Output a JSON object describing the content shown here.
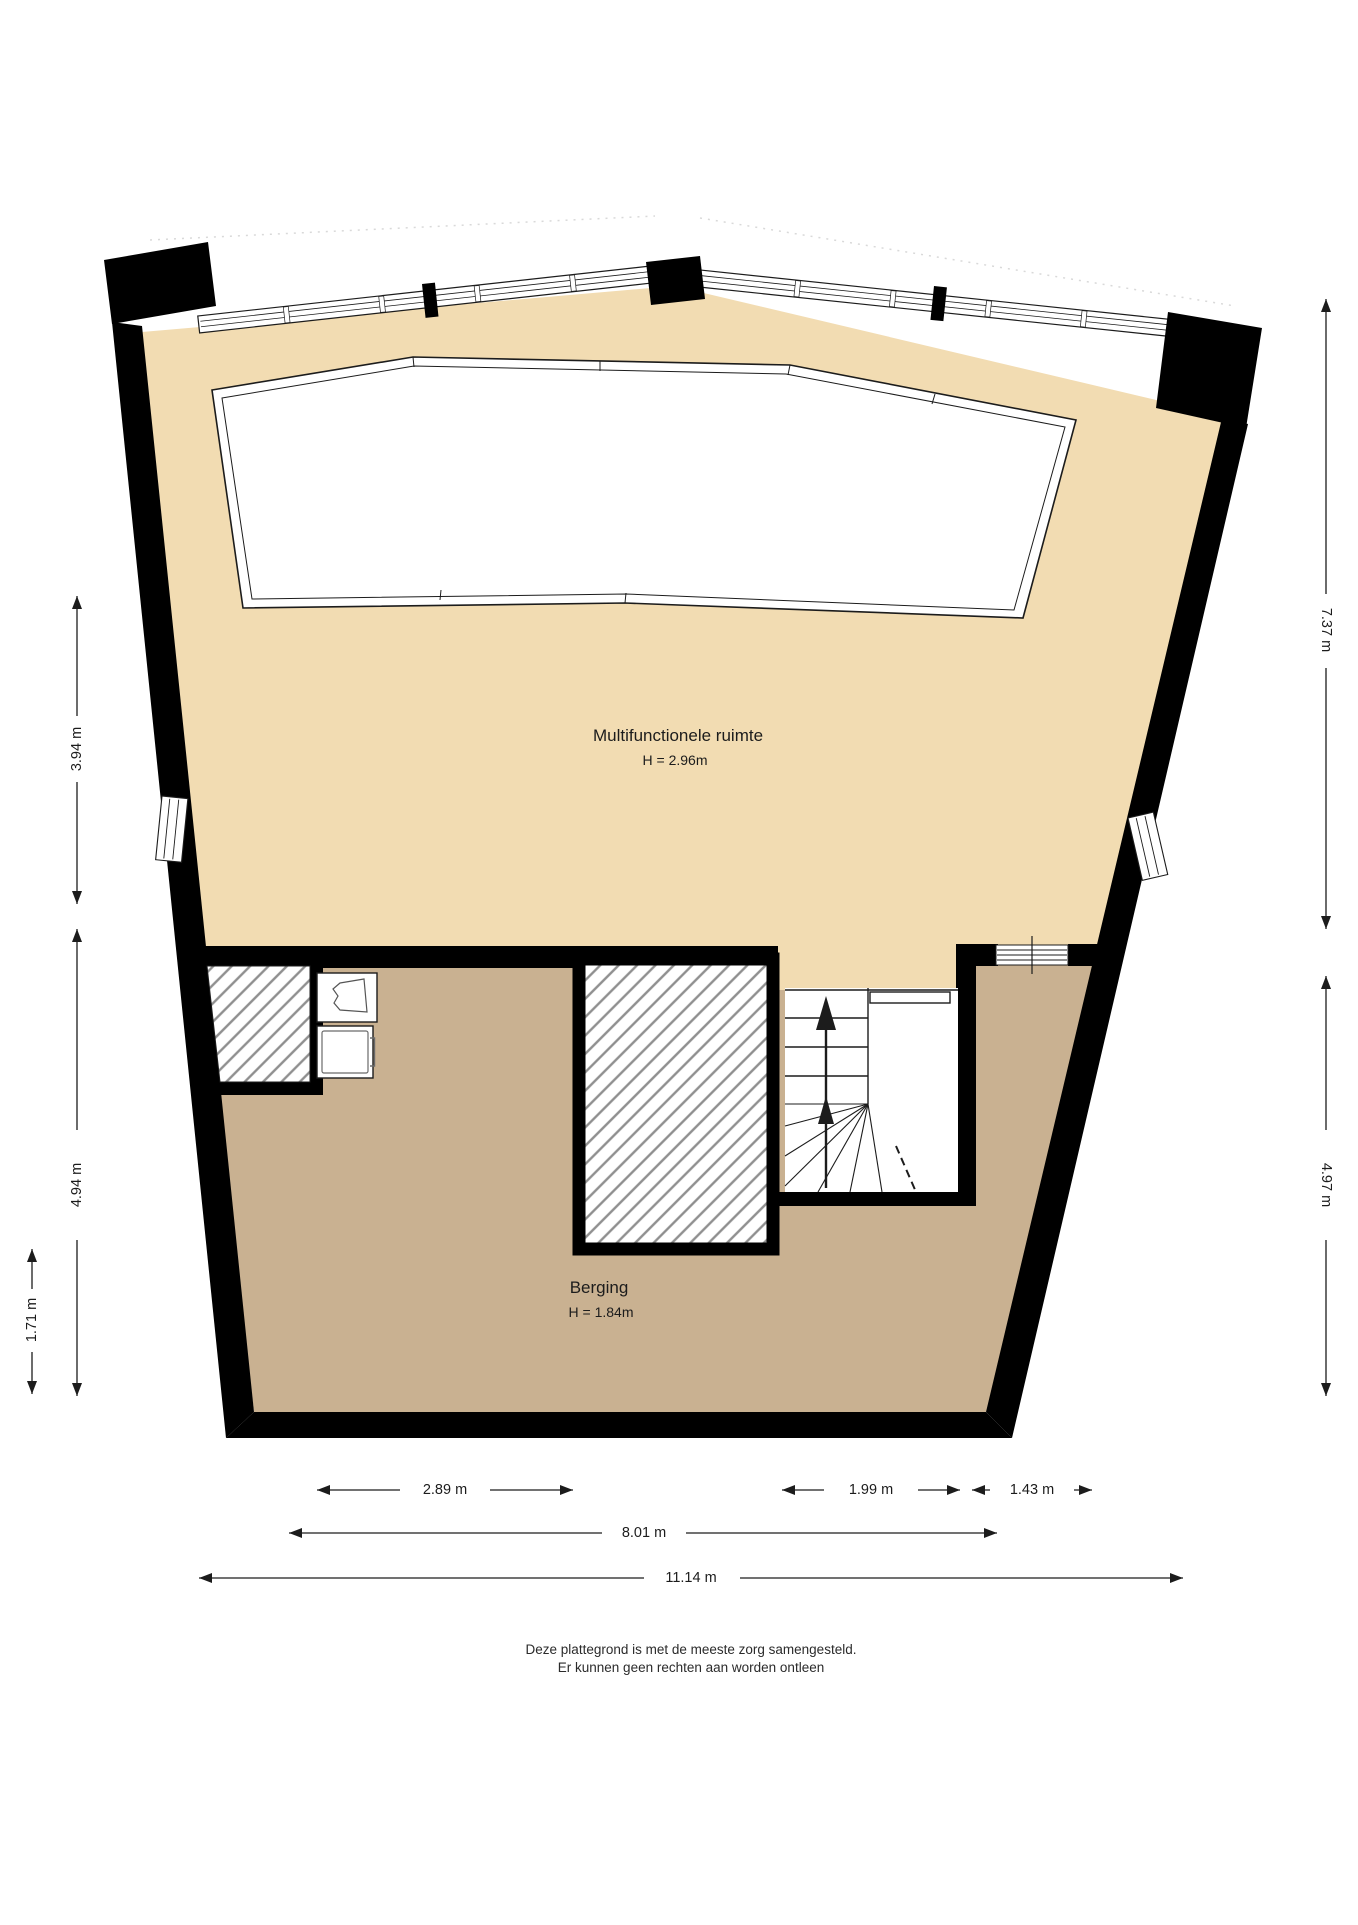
{
  "title": "Plattegrond",
  "rooms": {
    "multifunctioneel": {
      "name": "Multifunctionele ruimte",
      "height_label": "H = 2.96m"
    },
    "berging": {
      "name": "Berging",
      "height_label": "H = 1.84m"
    }
  },
  "dimensions": {
    "left": [
      {
        "label": "3.94 m"
      },
      {
        "label": "4.94 m"
      },
      {
        "label": "1.71 m"
      }
    ],
    "right": [
      {
        "label": "7.37 m"
      },
      {
        "label": "4.97 m"
      }
    ],
    "bottom": [
      {
        "label": "2.89 m"
      },
      {
        "label": "1.99 m"
      },
      {
        "label": "1.43 m"
      },
      {
        "label": "8.01 m"
      },
      {
        "label": "11.14 m"
      }
    ]
  },
  "footer": {
    "line1": "Deze plattegrond is met de meeste zorg samengesteld.",
    "line2": "Er kunnen geen rechten aan worden ontleen"
  },
  "colors": {
    "floor_light": "#f2dcb2",
    "floor_dark": "#c9b191",
    "wall": "#000000",
    "hatch": "#8f8f8f",
    "outline": "#1c1c1c"
  },
  "icons": {
    "up_arrow": "stairs-up-direction",
    "sink": "washbasin",
    "washer": "washing-machine"
  }
}
